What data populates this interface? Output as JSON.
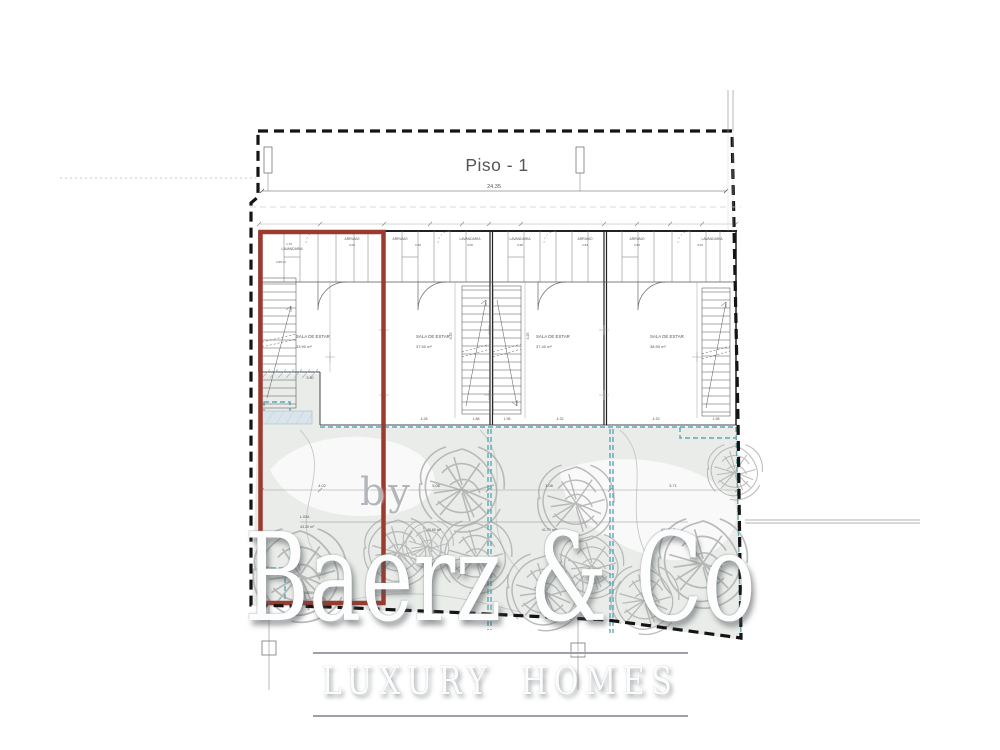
{
  "plan": {
    "title": "Piso - 1",
    "total_width_dim": "24.35",
    "units": [
      {
        "closet_left": "LAVANDARIA",
        "closet_left_area": "3.55 m²",
        "closet_right": "ARRUMO",
        "living_label": "SALA DE ESTAR",
        "living_area": "33.90 m²",
        "width_dim": "5.30",
        "garden_code": "L.02A",
        "garden_area": "43.20 m²",
        "garden_width_dim": "4.02",
        "floor_note": "JARDIM PVC"
      },
      {
        "closet_left": "ARRUMO",
        "closet_right": "LAVANDARIA",
        "living_label": "SALA DE ESTAR",
        "living_area": "37.50 m²",
        "width_dim": "4.28",
        "garden_area": "40.60 m²",
        "garden_width_dim": "5.08"
      },
      {
        "closet_left": "LAVANDARIA",
        "closet_right": "ARRUMO",
        "living_label": "SALA DE ESTAR",
        "living_area": "37.40 m²",
        "width_dim": "4.32",
        "garden_area": "41.70 m²",
        "garden_width_dim": "3.08"
      },
      {
        "closet_left": "ARRUMO",
        "closet_right": "LAVANDARIA",
        "living_label": "SALA DE ESTAR",
        "living_area": "38.90 m²",
        "width_dim": "4.33",
        "garden_area": "42.10 m²",
        "garden_width_dim": "3.71"
      }
    ],
    "stair_dims": [
      "1.88",
      "1.98",
      "1.98"
    ],
    "side_dims": [
      "4.25",
      "4.25"
    ],
    "closet_dims": [
      "1.70",
      "3.03",
      "0.60",
      "3.05",
      "0.98",
      "2.84",
      "0.60",
      "3.03"
    ]
  },
  "watermark": {
    "by": "by",
    "brand": "Baerz & Co",
    "tagline": "LUXURY HOMES"
  },
  "colors": {
    "red_outline": "#9d3a2e",
    "teal_dashed": "#5fa8b6",
    "garden_fill": "#e9ece8",
    "boundary": "#141414"
  }
}
